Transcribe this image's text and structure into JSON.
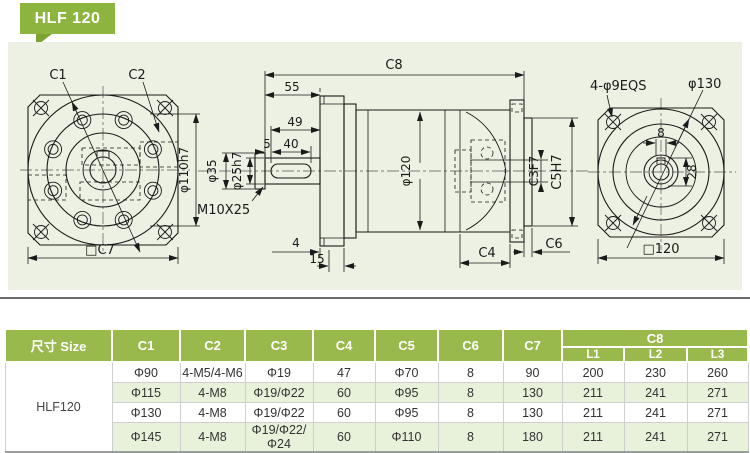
{
  "badge": {
    "label": "HLF 120"
  },
  "drawing": {
    "left_view": {
      "c1_label": "C1",
      "c2_label": "C2",
      "pilot_dia_label": "φ110h7",
      "square_label": "□C7"
    },
    "side_view": {
      "total_length_label": "C8",
      "shaft_length_label": "55",
      "dim49_label": "49",
      "dim5_label": "5",
      "keyway_length_label": "40",
      "shoulder_dia_label": "φ35",
      "shaft_dia_label": "φ25h7",
      "thread_label": "M10X25",
      "dim4_label": "4",
      "dim15_label": "15",
      "body_dia_label": "φ120",
      "input_bore_label": "C3F7",
      "input_pilot_label": "C5H7",
      "c4_label": "C4",
      "c6_label": "C6"
    },
    "right_view": {
      "corner_holes_label": "4-φ9EQS",
      "bolt_circle_label": "φ130",
      "key_width_label": "8",
      "hub_dia_label": "28",
      "square_label": "□120"
    }
  },
  "table": {
    "size_header": "尺寸 Size",
    "columns": [
      "C1",
      "C2",
      "C3",
      "C4",
      "C5",
      "C6",
      "C7"
    ],
    "c8_header": "C8",
    "c8_sub": [
      "L1",
      "L2",
      "L3"
    ],
    "model": "HLF120",
    "rows": [
      [
        "Φ90",
        "4-M5/4-M6",
        "Φ19",
        "47",
        "Φ70",
        "8",
        "90",
        "200",
        "230",
        "260"
      ],
      [
        "Φ115",
        "4-M8",
        "Φ19/Φ22",
        "60",
        "Φ95",
        "8",
        "130",
        "211",
        "241",
        "271"
      ],
      [
        "Φ130",
        "4-M8",
        "Φ19/Φ22",
        "60",
        "Φ95",
        "8",
        "130",
        "211",
        "241",
        "271"
      ],
      [
        "Φ145",
        "4-M8",
        "Φ19/Φ22/Φ24",
        "60",
        "Φ110",
        "8",
        "180",
        "211",
        "241",
        "271"
      ]
    ]
  },
  "colors": {
    "badge_green": "#8cb43e",
    "header_green": "#99b94c",
    "alt_row": "#e8f2db",
    "panel_bg": "#edf1e3"
  }
}
